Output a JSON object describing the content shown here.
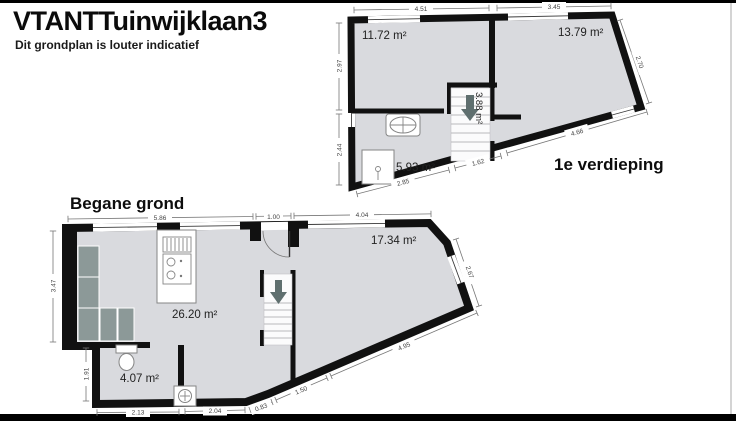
{
  "page": {
    "title": "VTANTTuinwijklaan3",
    "subtitle": "Dit grondplan is louter indicatief"
  },
  "first_floor": {
    "name": "1e verdieping",
    "areas": {
      "room_left": "11.72 m²",
      "room_right": "13.79 m²",
      "stairs": "3.88 m²",
      "bathroom": "5.93 m²"
    },
    "dims": {
      "top_left": "4.51",
      "top_right": "3.45",
      "right_slant": "2.70",
      "left_upper": "2.97",
      "left_lower": "2.44",
      "bottom_left": "2.85",
      "bottom_mid": "1.62",
      "bottom_right": "4.66"
    }
  },
  "ground_floor": {
    "name": "Begane grond",
    "areas": {
      "living_kitchen": "26.20 m²",
      "front_room": "17.34 m²",
      "toilet": "4.07 m²"
    },
    "dims": {
      "top_left": "5.86",
      "top_door": "1.00",
      "top_right": "4.04",
      "right_slant": "2.67",
      "left_upper": "3.47",
      "left_lower": "1.91",
      "bottom_left": "2.13",
      "bottom_mid": "2.04",
      "bottom_slant_short": "0.83",
      "bottom_slant_mid": "1.50",
      "bottom_slant_long": "4.95"
    }
  },
  "colors": {
    "floor_fill": "#d9dade",
    "wall": "#111111",
    "sofa": "#8c9998",
    "dimension": "#777777",
    "border_bar": "#000000"
  }
}
